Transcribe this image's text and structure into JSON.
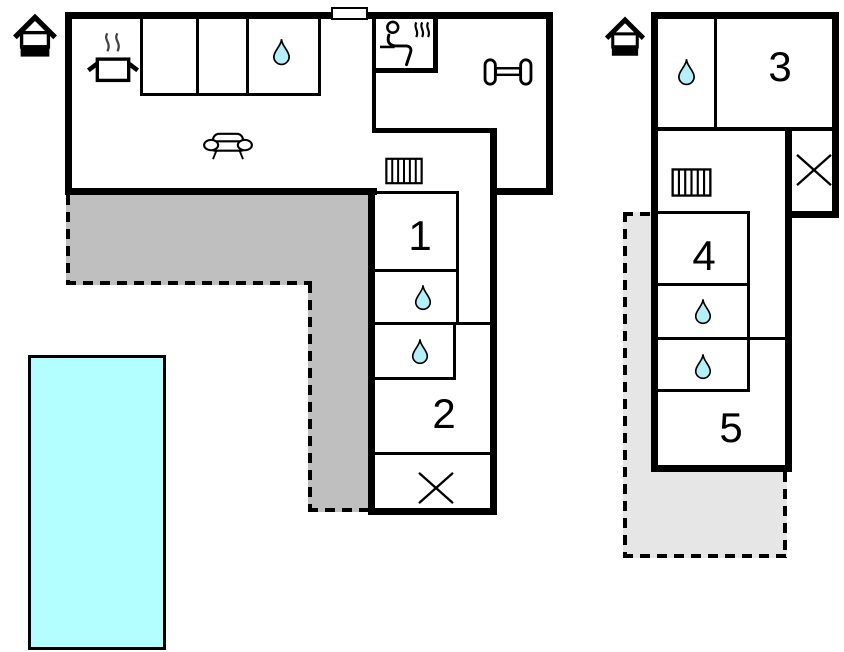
{
  "diagram_type": "floor-plan",
  "room_labels": {
    "r1": "1",
    "r2": "2",
    "r3": "3",
    "r4": "4",
    "r5": "5"
  },
  "colors": {
    "wall": "#000000",
    "background": "#ffffff",
    "pool_fill": "#b3ffff",
    "drop_fill": "#b4f0fa",
    "terrace_main_fill": "#bfbfbf",
    "terrace_annex_fill": "#e6e6e6"
  },
  "buildings": {
    "main_house": {
      "entrance_marker": "house-icon",
      "rooms": [
        {
          "id": "living-kitchen",
          "icons": [
            "cooking-pot-icon",
            "sofa-icon",
            "water-drop-icon"
          ]
        },
        {
          "id": "sauna",
          "icons": [
            "sauna-person-icon"
          ]
        },
        {
          "id": "gym",
          "icons": [
            "dumbbell-icon"
          ]
        },
        {
          "id": "hallway",
          "icons": [
            "radiator-icon"
          ]
        },
        {
          "id": "bedroom-1",
          "label": "1"
        },
        {
          "id": "bathroom-a",
          "icons": [
            "water-drop-icon"
          ]
        },
        {
          "id": "bathroom-b",
          "icons": [
            "water-drop-icon"
          ]
        },
        {
          "id": "bedroom-2",
          "label": "2"
        },
        {
          "id": "utility-room",
          "icons": [
            "window-cross-icon"
          ]
        },
        {
          "id": "window-marker-top-wall",
          "icons": [
            "window-marker"
          ]
        }
      ]
    },
    "annex": {
      "entrance_marker": "house-icon",
      "rooms": [
        {
          "id": "bathroom-c",
          "icons": [
            "water-drop-icon"
          ]
        },
        {
          "id": "bedroom-3",
          "label": "3"
        },
        {
          "id": "hallway",
          "icons": [
            "radiator-icon"
          ]
        },
        {
          "id": "utility-room",
          "icons": [
            "window-cross-icon"
          ]
        },
        {
          "id": "bedroom-4",
          "label": "4"
        },
        {
          "id": "bathroom-d",
          "icons": [
            "water-drop-icon"
          ]
        },
        {
          "id": "bathroom-e",
          "icons": [
            "water-drop-icon"
          ]
        },
        {
          "id": "bedroom-5",
          "label": "5"
        }
      ]
    }
  },
  "outdoor": {
    "swimming_pool": "pool",
    "terrace_main": "dashed-outline-terrace",
    "terrace_annex": "dashed-outline-terrace"
  }
}
